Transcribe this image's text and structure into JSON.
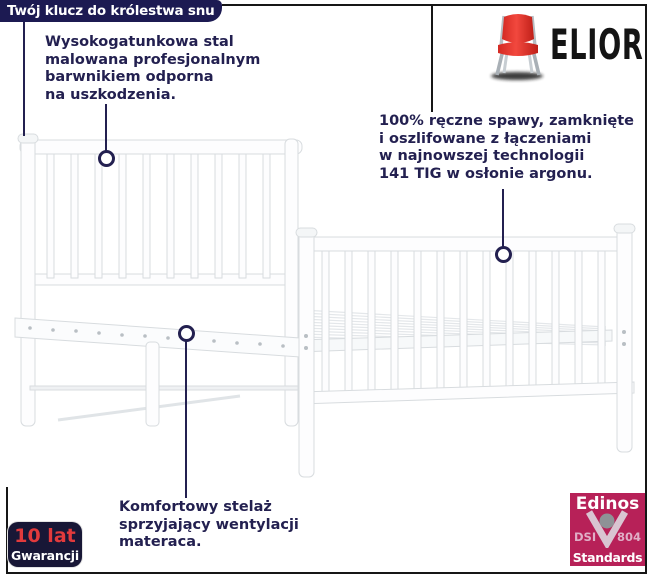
{
  "banner": {
    "text": "Twój klucz do królestwa snu"
  },
  "brand": {
    "name": "ELIOR",
    "icon": "red-chair-icon"
  },
  "annotations": {
    "steel": {
      "lines": [
        "Wysokogatunkowa stal",
        "malowana profesjonalnym",
        "barwnikiem odporna",
        "na uszkodzenia."
      ]
    },
    "welds": {
      "lines": [
        "100% ręczne spawy, zamknięte",
        "i oszlifowane z łączeniami",
        "w najnowszej technologii",
        "141 TIG w osłonie argonu."
      ]
    },
    "base": {
      "lines": [
        "Komfortowy stelaż",
        "sprzyjający wentylacji",
        "materaca."
      ]
    }
  },
  "badges": {
    "warranty": {
      "value": "10 lat",
      "label": "Gwarancji"
    },
    "certificate": {
      "brand": "Edinos",
      "left": "DSI",
      "right": "804",
      "bottom": "Standards",
      "icon": "v-circle-logo"
    }
  },
  "colors": {
    "navy": "#232050",
    "banner_navy": "#1c1a52",
    "warranty_navy": "#181736",
    "warranty_red": "#e23a3c",
    "certificate_raspberry": "#b72158",
    "chair_red": "#e0352d",
    "frame_line": "#161616",
    "bed_outline": "#d8dcdf"
  }
}
